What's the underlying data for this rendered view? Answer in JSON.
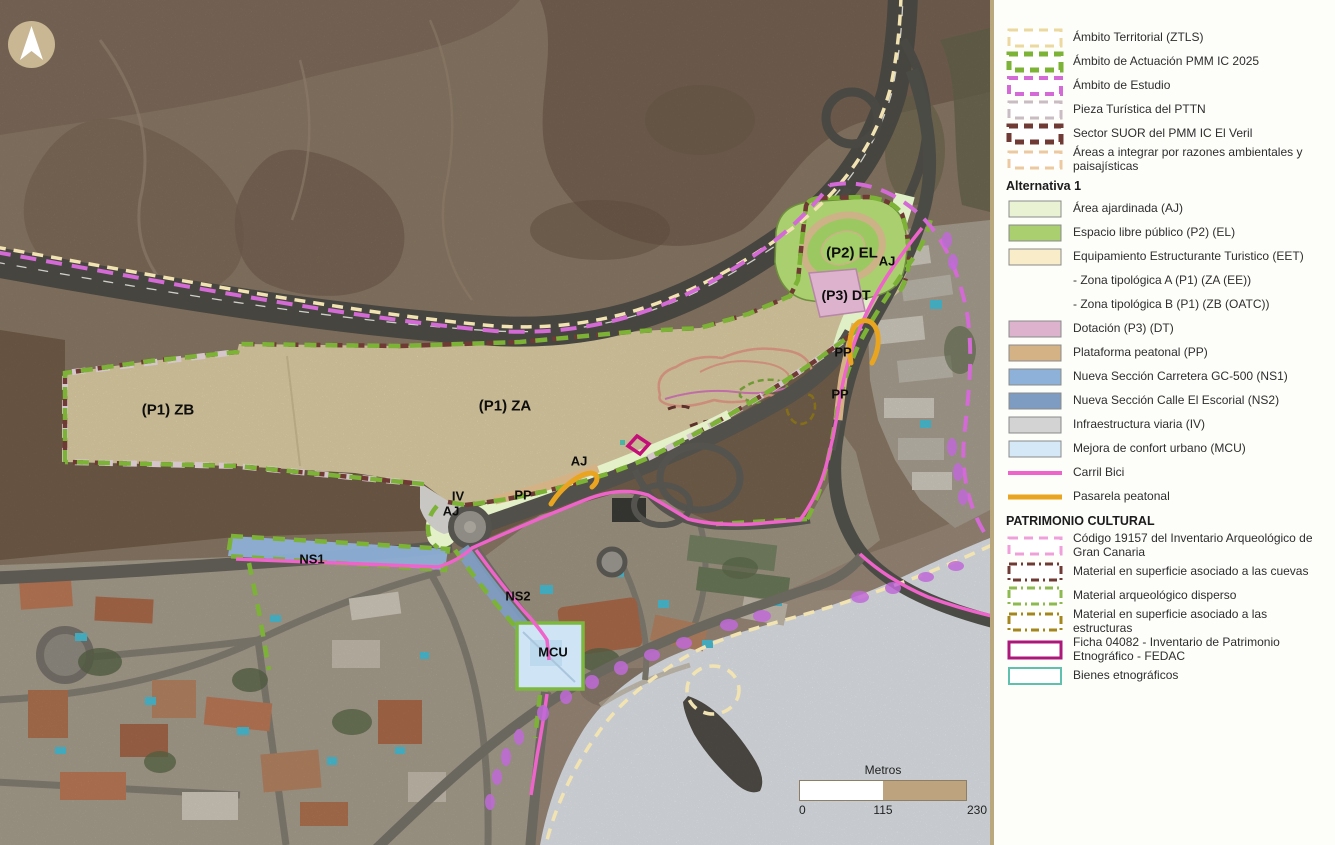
{
  "map": {
    "region_labels": [
      {
        "text": "(P1) ZB",
        "x": 168,
        "y": 410,
        "size": 15
      },
      {
        "text": "(P1) ZA",
        "x": 505,
        "y": 406,
        "size": 15
      },
      {
        "text": "(P2) EL",
        "x": 852,
        "y": 253,
        "size": 15
      },
      {
        "text": "AJ",
        "x": 887,
        "y": 261,
        "size": 13
      },
      {
        "text": "(P3) DT",
        "x": 846,
        "y": 295,
        "size": 14
      },
      {
        "text": "PP",
        "x": 843,
        "y": 352,
        "size": 13
      },
      {
        "text": "PP",
        "x": 840,
        "y": 394,
        "size": 13
      },
      {
        "text": "AJ",
        "x": 579,
        "y": 461,
        "size": 13
      },
      {
        "text": "PP",
        "x": 523,
        "y": 495,
        "size": 13
      },
      {
        "text": "IV",
        "x": 458,
        "y": 496,
        "size": 13
      },
      {
        "text": "AJ",
        "x": 451,
        "y": 511,
        "size": 13
      },
      {
        "text": "NS1",
        "x": 312,
        "y": 559,
        "size": 13
      },
      {
        "text": "NS2",
        "x": 518,
        "y": 596,
        "size": 13
      },
      {
        "text": "MCU",
        "x": 553,
        "y": 652,
        "size": 13
      }
    ],
    "compass": {
      "icon": "north-arrow"
    },
    "scalebar": {
      "title": "Metros",
      "ticks": [
        "0",
        "115",
        "230"
      ],
      "bar_colors": [
        "#ffffff",
        "#bda37e"
      ]
    }
  },
  "legend": {
    "rows": [
      {
        "type": "item",
        "label": "Ámbito Territorial (ZTLS)",
        "swatch": {
          "kind": "dashed",
          "color": "#ecd9a0",
          "weight": 3
        }
      },
      {
        "type": "item",
        "label": "Ámbito de Actuación PMM IC 2025",
        "swatch": {
          "kind": "dashed",
          "color": "#7cb236",
          "weight": 5
        }
      },
      {
        "type": "item",
        "label": "Ámbito de Estudio",
        "swatch": {
          "kind": "dashed",
          "color": "#d46ad6",
          "weight": 4
        }
      },
      {
        "type": "item",
        "label": "Pieza Turística del PTTN",
        "swatch": {
          "kind": "dashed",
          "color": "#c9bcc2",
          "weight": 3
        }
      },
      {
        "type": "item",
        "label": "Sector SUOR del PMM IC El Veril",
        "swatch": {
          "kind": "dashed",
          "color": "#6f3a34",
          "weight": 5
        }
      },
      {
        "type": "item",
        "label": "Áreas a integrar por razones ambientales y paisajísticas",
        "swatch": {
          "kind": "dashed",
          "color": "#ecc9a0",
          "weight": 3
        }
      },
      {
        "type": "header",
        "label": "Alternativa 1"
      },
      {
        "type": "item",
        "label": "Área ajardinada (AJ)",
        "swatch": {
          "kind": "fill",
          "color": "#e9f3d3"
        }
      },
      {
        "type": "item",
        "label": "Espacio libre público (P2) (EL)",
        "swatch": {
          "kind": "fill",
          "color": "#a9cf6e"
        }
      },
      {
        "type": "item",
        "label": "Equipamiento Estructurante Turistico (EET)",
        "swatch": {
          "kind": "fill",
          "color": "#f8ecc9"
        }
      },
      {
        "type": "subitem",
        "label": "- Zona tipológica A (P1) (ZA (EE))"
      },
      {
        "type": "subitem",
        "label": "- Zona tipológica B (P1) (ZB (OATC))"
      },
      {
        "type": "item",
        "label": "Dotación (P3) (DT)",
        "swatch": {
          "kind": "fill",
          "color": "#dcb2cd"
        }
      },
      {
        "type": "item",
        "label": "Plataforma peatonal (PP)",
        "swatch": {
          "kind": "fill",
          "color": "#d5b286"
        }
      },
      {
        "type": "item",
        "label": "Nueva Sección Carretera GC-500 (NS1)",
        "swatch": {
          "kind": "fill",
          "color": "#8db1d9"
        }
      },
      {
        "type": "item",
        "label": "Nueva Sección Calle El Escorial (NS2)",
        "swatch": {
          "kind": "fill",
          "color": "#7e9cc2"
        }
      },
      {
        "type": "item",
        "label": "Infraestructura viaria (IV)",
        "swatch": {
          "kind": "fill",
          "color": "#d3d3d3"
        }
      },
      {
        "type": "item",
        "label": "Mejora de confort urbano (MCU)",
        "swatch": {
          "kind": "fill",
          "color": "#d4e8f8"
        }
      },
      {
        "type": "item",
        "label": "Carril Bici",
        "swatch": {
          "kind": "line",
          "color": "#ef64cb",
          "weight": 4
        }
      },
      {
        "type": "item",
        "label": "Pasarela peatonal",
        "swatch": {
          "kind": "line",
          "color": "#e9a51f",
          "weight": 5
        }
      },
      {
        "type": "header",
        "label": "PATRIMONIO CULTURAL"
      },
      {
        "type": "item",
        "label": "Código 19157 del Inventario Arqueológico de Gran Canaria",
        "swatch": {
          "kind": "dashed",
          "color": "#efa0da",
          "weight": 3
        }
      },
      {
        "type": "item",
        "label": "Material en superficie asociado a las cuevas",
        "swatch": {
          "kind": "dashdot",
          "color": "#6f3a34",
          "weight": 3
        }
      },
      {
        "type": "item",
        "label": "Material arqueológico disperso",
        "swatch": {
          "kind": "dashdot",
          "color": "#8cba4e",
          "weight": 3
        }
      },
      {
        "type": "item",
        "label": "Material en superficie asociado a las estructuras",
        "swatch": {
          "kind": "dashdot",
          "color": "#a3861c",
          "weight": 3
        }
      },
      {
        "type": "item",
        "label": "Ficha 04082 - Inventario de Patrimonio Etnográfico - FEDAC",
        "swatch": {
          "kind": "outline",
          "color": "#ab1879",
          "weight": 3
        }
      },
      {
        "type": "item",
        "label": "Bienes etnográficos",
        "swatch": {
          "kind": "outline",
          "color": "#5fc0ae",
          "weight": 2
        }
      }
    ]
  },
  "colors": {
    "actuacion_green": "#7cb236",
    "estudio_magenta": "#d46ad6",
    "ztls_cream": "#f2e3b2",
    "suor_maroon": "#6f3a34",
    "carril_bici_pink": "#ef64cb",
    "pasarela_orange": "#e9a51f",
    "fedac_magenta": "#c40f78",
    "panel_border_tan": "#b9a87e"
  }
}
